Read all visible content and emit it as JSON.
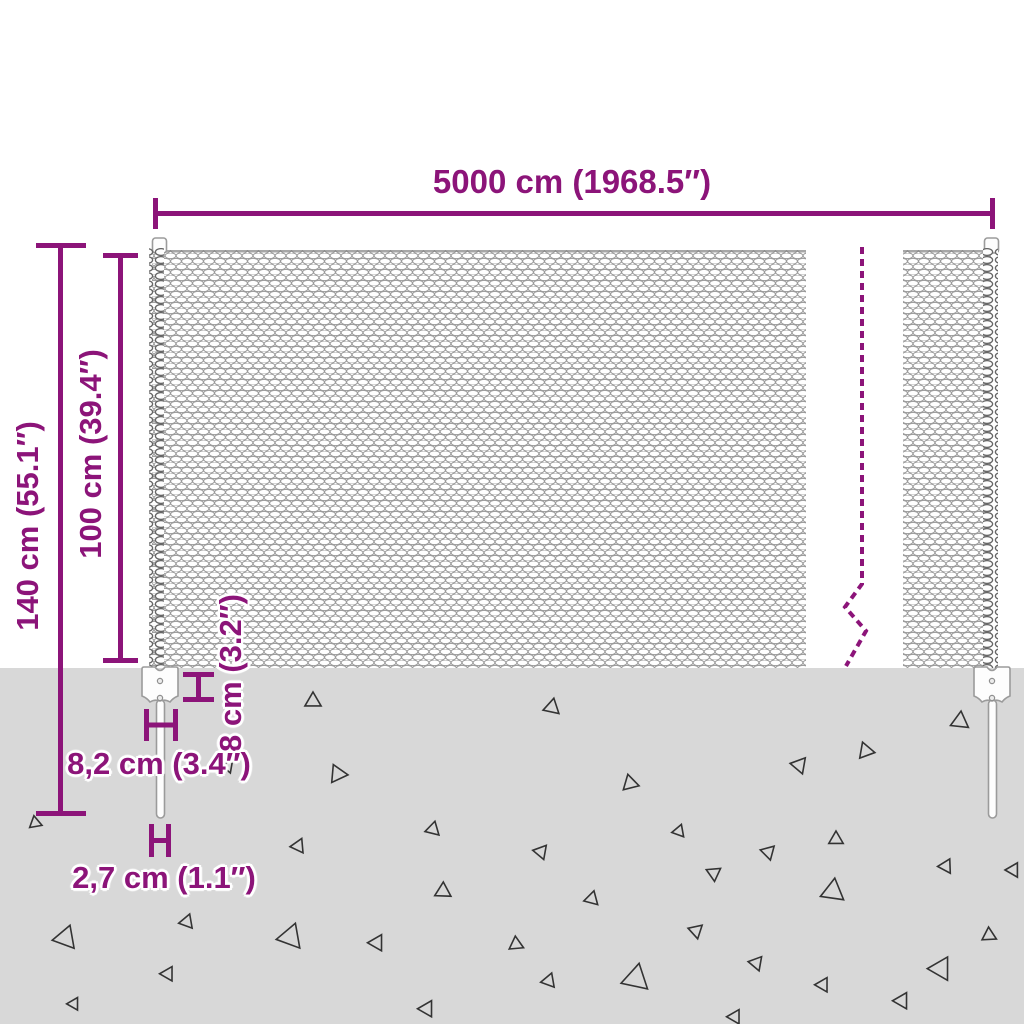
{
  "diagram": {
    "labels": {
      "width": "5000 cm (1968.5″)",
      "total_height": "140 cm (55.1″)",
      "mesh_height": "100 cm (39.4″)",
      "anchor_height": "8 cm (3.2″)",
      "anchor_width": "8,2 cm (3.4″)",
      "post_diameter": "2,7 cm (1.1″)"
    },
    "colors": {
      "accent": "#8C1479",
      "ground": "#D8D8D8",
      "mesh_line": "#9A9A9A",
      "coil_line": "#666666",
      "post_outline": "#9B9B9B",
      "stone": "#333333"
    },
    "stones": [
      {
        "x": 228,
        "y": 766,
        "s": 7,
        "r": 40
      },
      {
        "x": 35,
        "y": 823,
        "s": 7,
        "r": -130
      },
      {
        "x": 313,
        "y": 701,
        "s": 9,
        "r": 0
      },
      {
        "x": 552,
        "y": 707,
        "s": 9,
        "r": 12
      },
      {
        "x": 960,
        "y": 721,
        "s": 10,
        "r": 6
      },
      {
        "x": 866,
        "y": 751,
        "s": 9,
        "r": 100
      },
      {
        "x": 799,
        "y": 765,
        "s": 9,
        "r": -80
      },
      {
        "x": 338,
        "y": 774,
        "s": 10,
        "r": 95
      },
      {
        "x": 630,
        "y": 783,
        "s": 9,
        "r": -14
      },
      {
        "x": 433,
        "y": 829,
        "s": 8,
        "r": 14
      },
      {
        "x": 298,
        "y": 846,
        "s": 8,
        "r": -95
      },
      {
        "x": 541,
        "y": 852,
        "s": 8,
        "r": 160
      },
      {
        "x": 679,
        "y": 831,
        "s": 7,
        "r": 20
      },
      {
        "x": 714,
        "y": 873,
        "s": 8,
        "r": 55
      },
      {
        "x": 443,
        "y": 891,
        "s": 9,
        "r": 2
      },
      {
        "x": 592,
        "y": 899,
        "s": 8,
        "r": 135
      },
      {
        "x": 836,
        "y": 839,
        "s": 8,
        "r": 0
      },
      {
        "x": 768,
        "y": 852,
        "s": 8,
        "r": -75
      },
      {
        "x": 946,
        "y": 866,
        "s": 8,
        "r": 28
      },
      {
        "x": 833,
        "y": 891,
        "s": 13,
        "r": 8
      },
      {
        "x": 65,
        "y": 938,
        "s": 13,
        "r": -100
      },
      {
        "x": 187,
        "y": 922,
        "s": 8,
        "r": 140
      },
      {
        "x": 290,
        "y": 937,
        "s": 14,
        "r": -100
      },
      {
        "x": 377,
        "y": 943,
        "s": 9,
        "r": 150
      },
      {
        "x": 516,
        "y": 944,
        "s": 8,
        "r": -5
      },
      {
        "x": 168,
        "y": 974,
        "s": 8,
        "r": 150
      },
      {
        "x": 74,
        "y": 1004,
        "s": 7,
        "r": 150
      },
      {
        "x": 549,
        "y": 981,
        "s": 8,
        "r": 140
      },
      {
        "x": 636,
        "y": 978,
        "s": 15,
        "r": 12
      },
      {
        "x": 696,
        "y": 931,
        "s": 8,
        "r": 168
      },
      {
        "x": 427,
        "y": 1009,
        "s": 9,
        "r": 150
      },
      {
        "x": 989,
        "y": 935,
        "s": 8,
        "r": -3
      },
      {
        "x": 756,
        "y": 963,
        "s": 8,
        "r": -80
      },
      {
        "x": 941,
        "y": 969,
        "s": 13,
        "r": 150
      },
      {
        "x": 823,
        "y": 985,
        "s": 8,
        "r": 150
      },
      {
        "x": 902,
        "y": 1001,
        "s": 9,
        "r": 150
      },
      {
        "x": 735,
        "y": 1017,
        "s": 8,
        "r": 150
      },
      {
        "x": 1013,
        "y": 870,
        "s": 8,
        "r": -90
      }
    ]
  }
}
